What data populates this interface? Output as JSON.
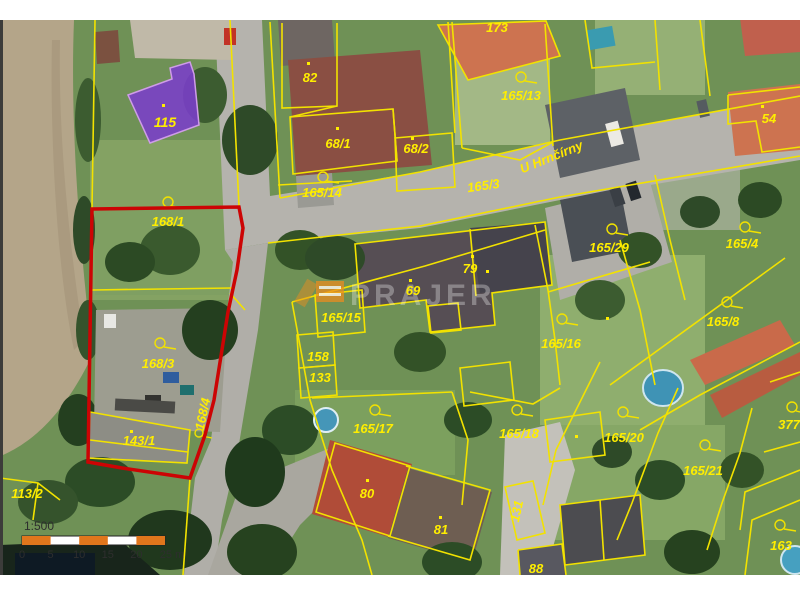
{
  "map": {
    "labels": [
      {
        "text": "115"
      },
      {
        "text": "173"
      },
      {
        "text": "82"
      },
      {
        "text": "68/1"
      },
      {
        "text": "68/2"
      },
      {
        "text": "165/14"
      },
      {
        "text": "165/3"
      },
      {
        "text": "165/13"
      },
      {
        "text": "U Hrnčírny"
      },
      {
        "text": "54"
      },
      {
        "text": "165/29"
      },
      {
        "text": "165/4"
      },
      {
        "text": "79"
      },
      {
        "text": "69"
      },
      {
        "text": "165/15"
      },
      {
        "text": "158"
      },
      {
        "text": "133"
      },
      {
        "text": "165/8"
      },
      {
        "text": "165/16"
      },
      {
        "text": "168/1"
      },
      {
        "text": "168/3"
      },
      {
        "text": "168/4"
      },
      {
        "text": "143/1"
      },
      {
        "text": "113/2"
      },
      {
        "text": "165/17"
      },
      {
        "text": "165/18"
      },
      {
        "text": "165/20"
      },
      {
        "text": "165/21"
      },
      {
        "text": "377"
      },
      {
        "text": "80"
      },
      {
        "text": "81"
      },
      {
        "text": "131"
      },
      {
        "text": "88"
      },
      {
        "text": "163"
      }
    ],
    "watermark": {
      "text": "PRAJER"
    },
    "scale_bar": {
      "ratio_label": "1:500",
      "ticks": [
        "0",
        "5",
        "10",
        "15",
        "20",
        "25 m"
      ]
    },
    "colors": {
      "cadastral_yellow": "#f2e200",
      "highlight_parcel_red": "#cc0404",
      "highlight_building_purple": "#7b3dcb",
      "scalebar_orange": "#e0761c"
    }
  }
}
